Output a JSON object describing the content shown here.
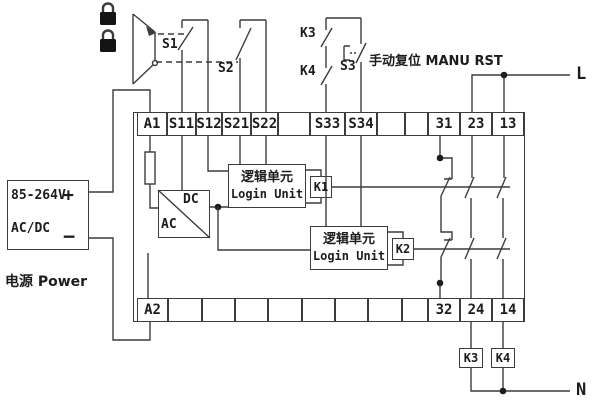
{
  "diagram_kind": "safety-relay wiring diagram",
  "terminals": {
    "top": [
      "A1",
      "S11",
      "S12",
      "S21",
      "S22",
      "",
      "S33",
      "S34",
      "",
      "",
      "31",
      "23",
      "13"
    ],
    "bottom": [
      "A2",
      "",
      "",
      "",
      "",
      "",
      "",
      "",
      "",
      "32",
      "24",
      "14"
    ]
  },
  "power_supply": {
    "voltage": "85-264V",
    "plus": "+",
    "minus": "−",
    "type": "AC/DC",
    "caption": "电源 Power"
  },
  "converter": {
    "dc_label": "DC",
    "ac_label": "AC"
  },
  "logic_unit": {
    "label_cn": "逻辑单元",
    "label_en": "Login Unit"
  },
  "relays": {
    "k1": "K1",
    "k2": "K2",
    "k3": "K3",
    "k4": "K4"
  },
  "switches": {
    "s1": "S1",
    "s2": "S2",
    "s3": "S3"
  },
  "manual_reset": {
    "label": "手动复位 MANU RST"
  },
  "power_lines": {
    "live": "L",
    "neutral": "N"
  },
  "colors": {
    "line": "#3c3c3c",
    "text": "#1c1c1c",
    "background": "#ffffff"
  }
}
